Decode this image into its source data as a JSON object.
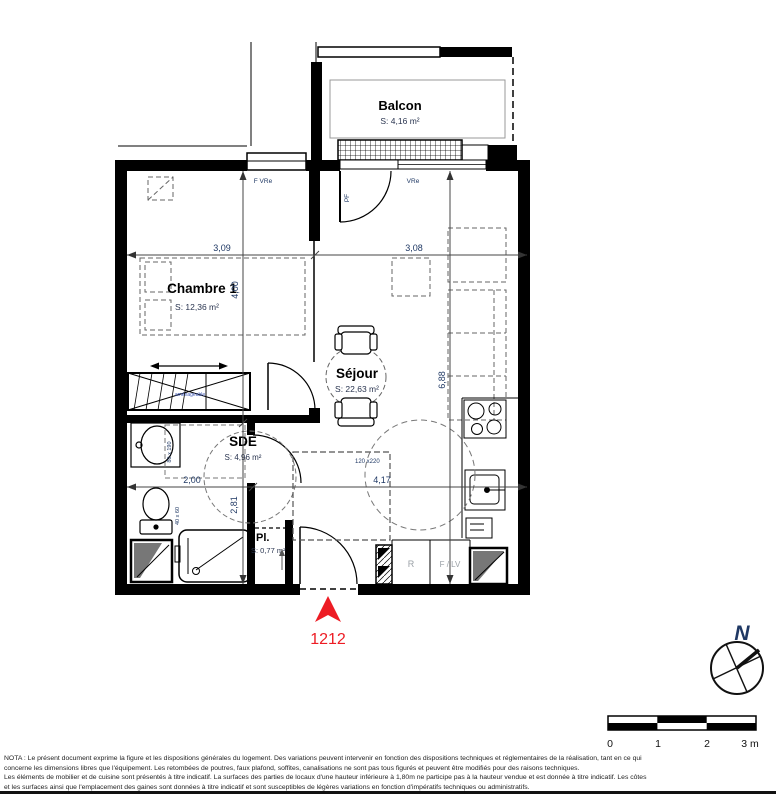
{
  "plan": {
    "balcony": {
      "name": "Balcon",
      "area": "S: 4,16 m²"
    },
    "bedroom": {
      "name": "Chambre 1",
      "area": "S: 12,36 m²"
    },
    "living": {
      "name": "Séjour",
      "area": "S: 22,63 m²"
    },
    "sde": {
      "name": "SDE",
      "area": "S: 4,96 m²"
    },
    "closet": {
      "name": "Pl.",
      "area": "S: 0,77 m²"
    },
    "lot_number": "1212",
    "labels": {
      "bedroom_window": "F VRe",
      "living_window": "VRe",
      "balcony_door": "PF",
      "fridge": "R",
      "dishwasher": "F / LV",
      "wardrobe": "aménageable"
    },
    "dims": {
      "bedroom_width": "3,09",
      "living_width": "3,08",
      "bedroom_height": "4,00",
      "sde_height": "2,81",
      "living_height": "6,88",
      "sde_width": "2,00",
      "kitchen_width": "4,17",
      "hall_clearance": "120 x220",
      "sde_clearance": "80 x 190",
      "wc_clearance": "40 x 60"
    }
  },
  "compass": {
    "north": "N"
  },
  "scale": {
    "t0": "0",
    "t1": "1",
    "t2": "2",
    "t3": "3 m"
  },
  "colors": {
    "accent_red": "#ed1c24",
    "dim_blue": "#1f3864",
    "label_gray": "#9aa0a6"
  },
  "nota": {
    "line1": "NOTA : Le présent document exprime la figure et les dispositions générales du logement. Des variations peuvent intervenir en fonction des dispositions techniques et réglementaires de la réalisation, tant en ce qui",
    "line2": "concerne les dimensions libres que l'équipement. Les retombées de poutres, faux plafond, soffites, canalisations ne sont pas tous figurés et peuvent être modifiés pour des raisons techniques.",
    "line3": "Les éléments de mobilier et de cuisine sont présentés à titre indicatif. La surfaces des parties de locaux d'une hauteur inférieure à 1,80m ne participe pas à la hauteur vendue et est donnée à titre indicatif. Les côtes",
    "line4": "et les surfaces ainsi que l'emplacement des gaines sont données à titre indicatif et sont susceptibles de légères variations en fonction d'impératifs techniques ou administratifs."
  }
}
